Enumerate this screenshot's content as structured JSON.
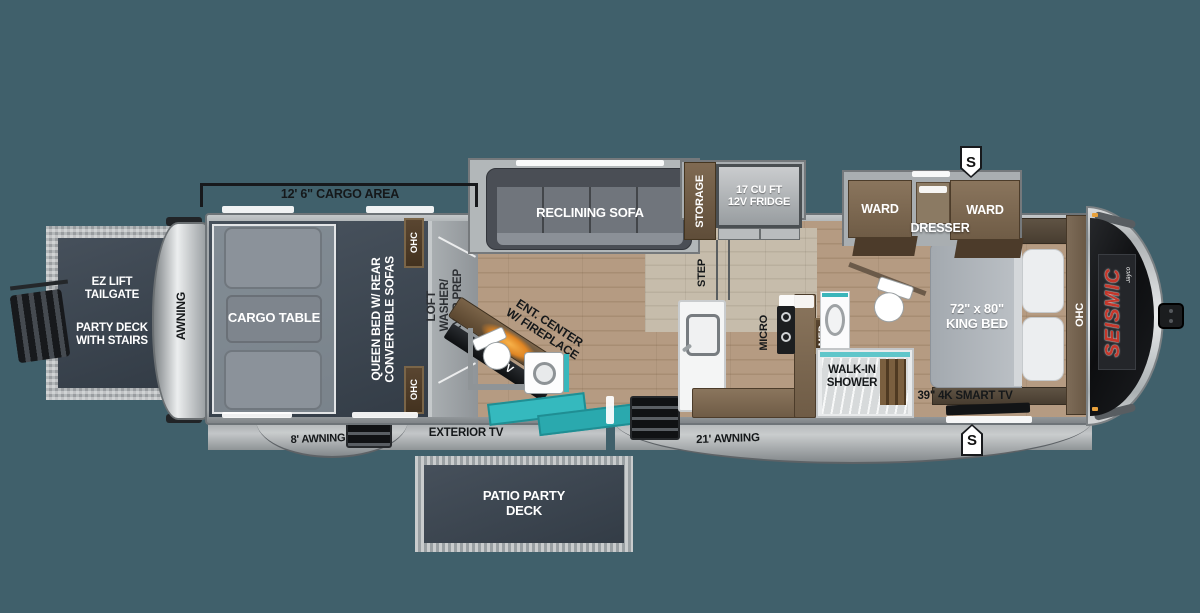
{
  "colors": {
    "background": "#40606B",
    "accent_teal": "#35B8BD",
    "brand_red": "#C4372B",
    "fireplace_orange": "#E89027",
    "navy_panel": "#39434E",
    "cabinet_brown": "#7B6852",
    "tag_brown": "#4A3827"
  },
  "dimension_label": "12' 6\" CARGO AREA",
  "rear_deck": {
    "tailgate": "EZ LIFT TAILGATE",
    "party_deck": "PARTY DECK WITH STAIRS"
  },
  "rear_awning": {
    "side": "AWNING",
    "bottom": "8' AWNING"
  },
  "cargo_area": {
    "table": "CARGO TABLE",
    "queen_line1": "QUEEN BED W/ REAR",
    "queen_line2": "CONVERTIBLE SOFAS",
    "ohc_top": "OHC",
    "ohc_bottom": "OHC"
  },
  "loft": {
    "name": "LOFT",
    "prep_line1": "WASHER/",
    "prep_line2": "DRYER PREP"
  },
  "living": {
    "sofa": "RECLINING SOFA",
    "storage": "STORAGE",
    "fridge_line1": "17 CU FT",
    "fridge_line2": "12V FRIDGE",
    "step": "STEP",
    "ent_line1": "ENT. CENTER",
    "ent_line2": "W/ FIREPLACE",
    "tv": "50\" TV"
  },
  "kitchen": {
    "micro": "MICRO"
  },
  "bath": {
    "med": "MED",
    "shower": "WALK-IN SHOWER"
  },
  "bedroom": {
    "ward_left": "WARD",
    "ward_right": "WARD",
    "dresser": "DRESSER",
    "bed_line1": "72\" x 80\"",
    "bed_line2": "KING BED",
    "smart_tv": "39\" 4K SMART TV",
    "ohc": "OHC"
  },
  "front": {
    "brand": "SEISMIC",
    "brand_sub": "Jayco",
    "badge_top": "S",
    "badge_bottom": "S"
  },
  "exterior": {
    "exterior_tv": "EXTERIOR TV",
    "awning_21": "21' AWNING",
    "patio": "PATIO PARTY DECK"
  }
}
